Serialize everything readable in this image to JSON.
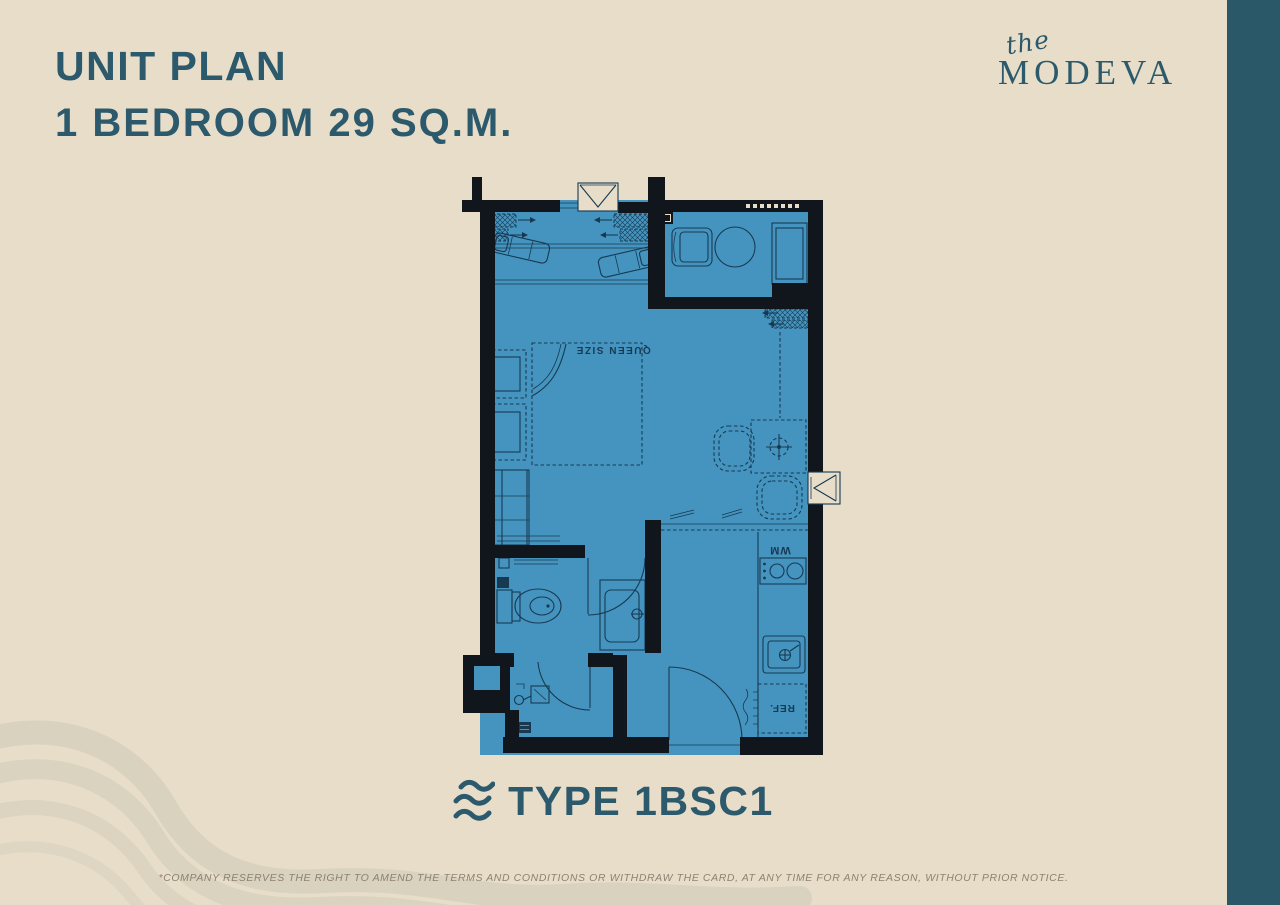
{
  "theme": {
    "bg": "#e7ddc9",
    "accent": "#2c5a6c",
    "band": "#2b5868",
    "floor": "#4594bf",
    "wall": "#10161c",
    "line": "#173a52",
    "muted": "#8e8172",
    "wave": "#ccc8b6"
  },
  "header": {
    "title_line1": "UNIT PLAN",
    "title_line2": "1 BEDROOM 29 SQ.M."
  },
  "brand": {
    "prefix": "the",
    "name": "MODEVA"
  },
  "floor_plan": {
    "labels": {
      "bed": "QUEEN SIZE",
      "washing_machine": "WM",
      "refrigerator": "REF."
    }
  },
  "unit_type": {
    "label": "TYPE 1BSC1"
  },
  "disclaimer": "*COMPANY RESERVES THE RIGHT TO AMEND THE TERMS AND CONDITIONS OR WITHDRAW THE CARD, AT ANY TIME FOR ANY REASON, WITHOUT PRIOR NOTICE."
}
